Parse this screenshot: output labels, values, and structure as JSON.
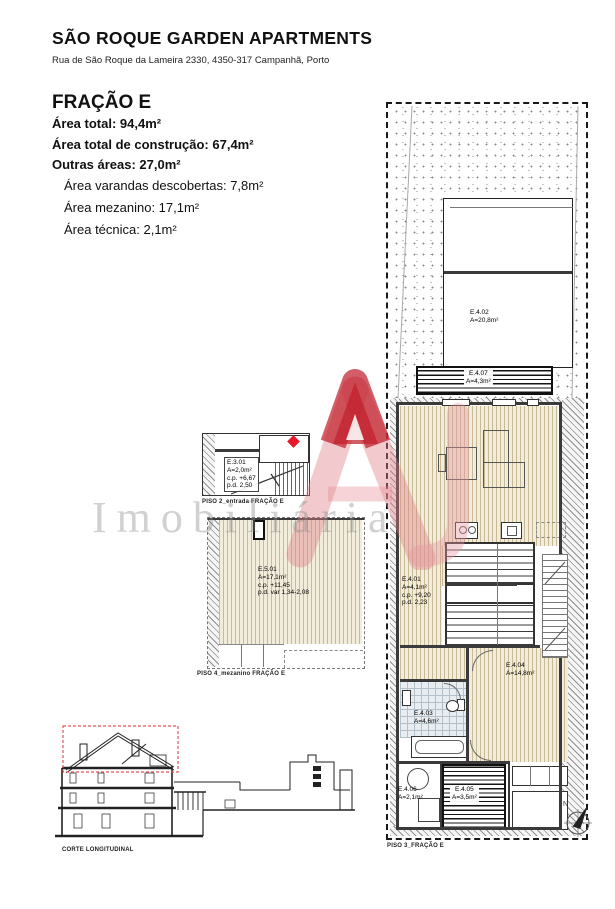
{
  "header": {
    "title": "SÃO ROQUE GARDEN APARTMENTS",
    "address": "Rua de São Roque da Lameira 2330, 4350-317 Campanhã, Porto"
  },
  "fraction": {
    "name": "FRAÇÃO E",
    "area_total": "Área total: 94,4m²",
    "area_construcao": "Área total de construção: 67,4m²",
    "outras_areas": "Outras áreas: 27,0m²",
    "area_varandas": "Área varandas descobertas: 7,8m²",
    "area_mezanino": "Área mezanino: 17,1m²",
    "area_tecnica": "Área técnica: 2,1m²"
  },
  "rooms": {
    "e301": {
      "id": "E.3.01",
      "area": "A=2,0m²",
      "cp": "c.p. +6,67",
      "pd": "p.d. 2,50"
    },
    "e501": {
      "id": "E.5.01",
      "area": "A=17,1m²",
      "cp": "c.p. +11,45",
      "pd": "p.d. var 1,34-2,08"
    },
    "e401": {
      "id": "E.4.01",
      "area": "A=4,1m²",
      "cp": "c.p. +9,20",
      "pd": "p.d. 2,23"
    },
    "e402": {
      "id": "E.4.02",
      "area": "A=20,8m²"
    },
    "e403": {
      "id": "E.4.03",
      "area": "A=4,6m²"
    },
    "e404": {
      "id": "E.4.04",
      "area": "A=14,8m²"
    },
    "e405": {
      "id": "E.4.05",
      "area": "A=3,5m²"
    },
    "e406": {
      "id": "E.4.06",
      "area": "A=2,1m²"
    },
    "e407": {
      "id": "E.4.07",
      "area": "A=4,3m²"
    }
  },
  "captions": {
    "entrada": "PISO 2_entrada FRAÇÃO E",
    "mezanino": "PISO 4_mezanino FRAÇÃO E",
    "piso3": "PISO 3_FRAÇÃO E",
    "corte": "CORTE LONGITUDINAL"
  },
  "compass": {
    "north": "N"
  },
  "watermark": {
    "text": "Imobiliária"
  },
  "colors": {
    "wood_floor": "#f2ecda",
    "tile_floor": "#e7edf0",
    "logo_red": "#cf2e3a",
    "pin_red": "#e8192c",
    "highlight_red_dash": "#e25555"
  }
}
